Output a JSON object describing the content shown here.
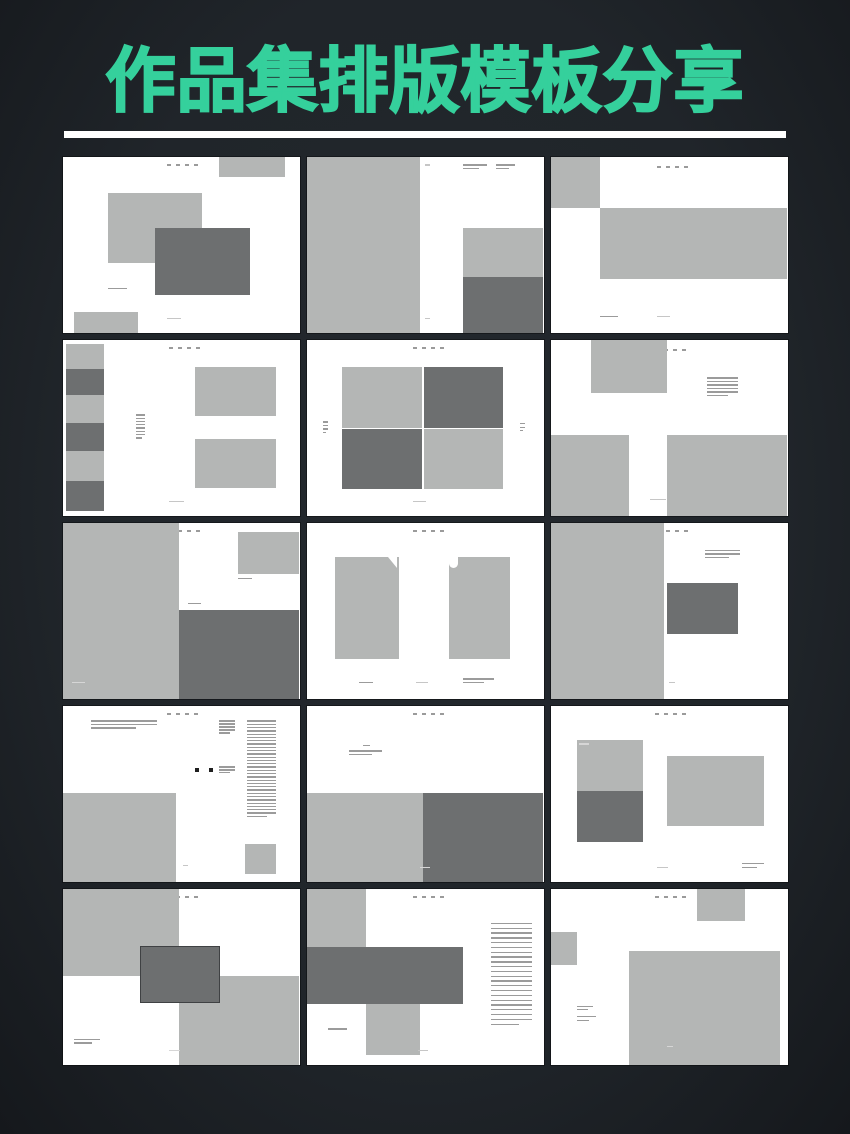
{
  "page": {
    "title": "作品集排版模板分享",
    "colors": {
      "background": "#20252a",
      "title_green": "#35d09c",
      "underline": "#ffffff",
      "slide_white": "#ffffff",
      "light_gray": "#b4b6b5",
      "dark_gray": "#6d6f70",
      "caption_gray": "#9b9b9b",
      "faint_gray": "#c6c6c6",
      "on_gray_text": "#d6d6d6",
      "bullet_black": "#1f1f1f",
      "center_rect_border": "#3f4143"
    }
  },
  "grid": {
    "rows": 5,
    "cols": 3,
    "thumb_count": 15
  },
  "thumbnails": [
    {
      "name": "spread-01-overlapping-images",
      "elements": [
        {
          "t": "dots",
          "x": 44,
          "y": 4
        },
        {
          "t": "rect",
          "x": 66,
          "y": 0,
          "w": 28,
          "h": 11,
          "tone": "light"
        },
        {
          "t": "rect",
          "x": 19,
          "y": 20,
          "w": 40,
          "h": 40,
          "tone": "light"
        },
        {
          "t": "rect",
          "x": 39,
          "y": 40,
          "w": 40,
          "h": 38,
          "tone": "dark"
        },
        {
          "t": "lines",
          "x": 19,
          "y": 74,
          "w": 12,
          "n": 1,
          "tone": "caption"
        },
        {
          "t": "rect",
          "x": 5,
          "y": 88,
          "w": 27,
          "h": 12,
          "tone": "light"
        },
        {
          "t": "lines",
          "x": 44,
          "y": 91,
          "w": 9,
          "n": 1,
          "tone": "faint"
        }
      ]
    },
    {
      "name": "spread-02-half-page-image",
      "elements": [
        {
          "t": "rect",
          "x": 0,
          "y": 0,
          "w": 48,
          "h": 100,
          "tone": "light"
        },
        {
          "t": "lines",
          "x": 66,
          "y": 4,
          "w": 10,
          "n": 2,
          "tone": "caption"
        },
        {
          "t": "lines",
          "x": 80,
          "y": 4,
          "w": 8,
          "n": 2,
          "tone": "caption"
        },
        {
          "t": "lines",
          "x": 50,
          "y": 4,
          "w": 3,
          "n": 1,
          "tone": "faint"
        },
        {
          "t": "rect",
          "x": 66,
          "y": 40,
          "w": 34,
          "h": 28,
          "tone": "light"
        },
        {
          "t": "rect",
          "x": 66,
          "y": 68,
          "w": 34,
          "h": 32,
          "tone": "dark"
        },
        {
          "t": "lines",
          "x": 50,
          "y": 91,
          "w": 3,
          "n": 1,
          "tone": "faint"
        }
      ]
    },
    {
      "name": "spread-03-banner-image",
      "elements": [
        {
          "t": "dots",
          "x": 45,
          "y": 5
        },
        {
          "t": "rect",
          "x": 0,
          "y": 0,
          "w": 21,
          "h": 29,
          "tone": "light"
        },
        {
          "t": "rect",
          "x": 21,
          "y": 29,
          "w": 79,
          "h": 40,
          "tone": "light"
        },
        {
          "t": "lines",
          "x": 21,
          "y": 90,
          "w": 11,
          "n": 1,
          "tone": "caption"
        },
        {
          "t": "lines",
          "x": 45,
          "y": 90,
          "w": 8,
          "n": 1,
          "tone": "faint"
        }
      ]
    },
    {
      "name": "spread-04-filmstrip-left",
      "elements": [
        {
          "t": "dots",
          "x": 45,
          "y": 4
        },
        {
          "t": "rect",
          "x": 1.5,
          "y": 2,
          "w": 16,
          "h": 14,
          "tone": "light"
        },
        {
          "t": "rect",
          "x": 1.5,
          "y": 16,
          "w": 16,
          "h": 15,
          "tone": "dark"
        },
        {
          "t": "rect",
          "x": 1.5,
          "y": 31,
          "w": 16,
          "h": 16,
          "tone": "light"
        },
        {
          "t": "rect",
          "x": 1.5,
          "y": 47,
          "w": 16,
          "h": 16,
          "tone": "dark"
        },
        {
          "t": "rect",
          "x": 1.5,
          "y": 63,
          "w": 16,
          "h": 17,
          "tone": "light"
        },
        {
          "t": "rect",
          "x": 1.5,
          "y": 80,
          "w": 16,
          "h": 17,
          "tone": "dark"
        },
        {
          "t": "lines",
          "x": 31,
          "y": 42,
          "w": 4,
          "n": 8,
          "lh": 3.3,
          "tone": "caption"
        },
        {
          "t": "rect",
          "x": 56,
          "y": 15,
          "w": 34,
          "h": 28,
          "tone": "light"
        },
        {
          "t": "rect",
          "x": 56,
          "y": 56,
          "w": 34,
          "h": 28,
          "tone": "light"
        },
        {
          "t": "lines",
          "x": 45,
          "y": 91,
          "w": 9,
          "n": 1,
          "tone": "faint"
        }
      ]
    },
    {
      "name": "spread-05-checkerboard-grid",
      "elements": [
        {
          "t": "dots",
          "x": 45,
          "y": 4
        },
        {
          "t": "rect",
          "x": 15,
          "y": 15,
          "w": 33.6,
          "h": 34.6,
          "tone": "light"
        },
        {
          "t": "rect",
          "x": 49.4,
          "y": 15,
          "w": 33.6,
          "h": 34.6,
          "tone": "dark"
        },
        {
          "t": "rect",
          "x": 15,
          "y": 50.4,
          "w": 33.6,
          "h": 34,
          "tone": "dark"
        },
        {
          "t": "rect",
          "x": 49.4,
          "y": 50.4,
          "w": 33.6,
          "h": 34,
          "tone": "light"
        },
        {
          "t": "lines",
          "x": 7,
          "y": 46,
          "w": 2,
          "n": 4,
          "tone": "caption"
        },
        {
          "t": "lines",
          "x": 90,
          "y": 47,
          "w": 2,
          "n": 3,
          "tone": "caption"
        },
        {
          "t": "lines",
          "x": 45,
          "y": 91,
          "w": 8,
          "n": 1,
          "tone": "faint"
        }
      ]
    },
    {
      "name": "spread-06-three-blocks",
      "elements": [
        {
          "t": "dots",
          "x": 44,
          "y": 5
        },
        {
          "t": "rect",
          "x": 17,
          "y": 0,
          "w": 32,
          "h": 30,
          "tone": "light"
        },
        {
          "t": "lines",
          "x": 66,
          "y": 21,
          "w": 13,
          "n": 6,
          "tone": "caption"
        },
        {
          "t": "rect",
          "x": 0,
          "y": 54,
          "w": 33,
          "h": 46,
          "tone": "light"
        },
        {
          "t": "rect",
          "x": 49,
          "y": 54,
          "w": 51,
          "h": 46,
          "tone": "light"
        },
        {
          "t": "lines",
          "x": 42,
          "y": 90,
          "w": 10,
          "n": 1,
          "tone": "faint"
        }
      ]
    },
    {
      "name": "spread-07-half-image-dark-corner",
      "elements": [
        {
          "t": "dots",
          "x": 45,
          "y": 4
        },
        {
          "t": "rect",
          "x": 0,
          "y": 0,
          "w": 49,
          "h": 100,
          "tone": "light"
        },
        {
          "t": "rect",
          "x": 74,
          "y": 5,
          "w": 26,
          "h": 24,
          "tone": "light"
        },
        {
          "t": "lines",
          "x": 74,
          "y": 31,
          "w": 9,
          "n": 1,
          "tone": "caption"
        },
        {
          "t": "lines",
          "x": 53,
          "y": 45,
          "w": 8,
          "n": 1,
          "tone": "caption"
        },
        {
          "t": "rect",
          "x": 49,
          "y": 49,
          "w": 51,
          "h": 51,
          "tone": "dark"
        },
        {
          "t": "lines",
          "x": 4,
          "y": 90,
          "w": 8,
          "n": 1,
          "tone": "onGray"
        }
      ]
    },
    {
      "name": "spread-08-two-portrait-images",
      "elements": [
        {
          "t": "dots",
          "x": 45,
          "y": 4
        },
        {
          "t": "rect",
          "x": 12,
          "y": 19,
          "w": 27,
          "h": 58,
          "tone": "light"
        },
        {
          "t": "rect",
          "x": 60,
          "y": 19,
          "w": 26,
          "h": 58,
          "tone": "light"
        },
        {
          "t": "notch",
          "x": 34.5,
          "y": 19,
          "shape": "v"
        },
        {
          "t": "notch",
          "x": 60,
          "y": 19,
          "shape": "j"
        },
        {
          "t": "lines",
          "x": 22,
          "y": 90,
          "w": 9,
          "n": 1,
          "tone": "caption"
        },
        {
          "t": "lines",
          "x": 46,
          "y": 90,
          "w": 8,
          "n": 1,
          "tone": "faint"
        },
        {
          "t": "lines",
          "x": 66,
          "y": 88,
          "w": 13,
          "n": 2,
          "tone": "caption"
        }
      ]
    },
    {
      "name": "spread-09-half-image-center-rect",
      "elements": [
        {
          "t": "dots",
          "x": 45,
          "y": 4
        },
        {
          "t": "rect",
          "x": 0,
          "y": 0,
          "w": 48,
          "h": 100,
          "tone": "light"
        },
        {
          "t": "lines",
          "x": 65,
          "y": 15,
          "w": 15,
          "n": 3,
          "tone": "caption"
        },
        {
          "t": "rect",
          "x": 49,
          "y": 34,
          "w": 30,
          "h": 29,
          "tone": "dark"
        },
        {
          "t": "lines",
          "x": 50,
          "y": 90,
          "w": 4,
          "n": 1,
          "tone": "faint"
        }
      ]
    },
    {
      "name": "spread-10-text-heavy-editorial",
      "elements": [
        {
          "t": "dots",
          "x": 44,
          "y": 4
        },
        {
          "t": "lines",
          "x": 12,
          "y": 8,
          "w": 28,
          "n": 3,
          "tone": "caption"
        },
        {
          "t": "lines",
          "x": 66,
          "y": 8,
          "w": 7,
          "n": 5,
          "lh": 3,
          "tone": "caption"
        },
        {
          "t": "lines",
          "x": 78,
          "y": 8,
          "w": 12,
          "n": 30,
          "lh": 3.3,
          "tone": "caption"
        },
        {
          "t": "bullet",
          "x": 56,
          "y": 35
        },
        {
          "t": "bullet",
          "x": 62,
          "y": 35
        },
        {
          "t": "lines",
          "x": 66,
          "y": 34,
          "w": 7,
          "n": 3,
          "lh": 3,
          "tone": "caption"
        },
        {
          "t": "rect",
          "x": 0,
          "y": 49,
          "w": 48,
          "h": 51,
          "tone": "light"
        },
        {
          "t": "rect",
          "x": 77,
          "y": 78,
          "w": 13,
          "h": 17,
          "tone": "light"
        },
        {
          "t": "lines",
          "x": 51,
          "y": 90,
          "w": 3,
          "n": 1,
          "tone": "faint"
        }
      ]
    },
    {
      "name": "spread-11-split-bottom-half",
      "elements": [
        {
          "t": "dots",
          "x": 45,
          "y": 4
        },
        {
          "t": "lines",
          "x": 24,
          "y": 22,
          "w": 4,
          "n": 1,
          "tone": "caption"
        },
        {
          "t": "lines",
          "x": 18,
          "y": 25,
          "w": 14,
          "n": 2,
          "tone": "caption"
        },
        {
          "t": "rect",
          "x": 0,
          "y": 49,
          "w": 49,
          "h": 51,
          "tone": "light"
        },
        {
          "t": "rect",
          "x": 49,
          "y": 49,
          "w": 51,
          "h": 51,
          "tone": "dark"
        },
        {
          "t": "lines",
          "x": 48,
          "y": 91,
          "w": 6,
          "n": 1,
          "tone": "onGray"
        }
      ]
    },
    {
      "name": "spread-12-stacked-and-single",
      "elements": [
        {
          "t": "dots",
          "x": 44,
          "y": 4
        },
        {
          "t": "rect",
          "x": 11,
          "y": 19,
          "w": 28,
          "h": 29,
          "tone": "light"
        },
        {
          "t": "rect",
          "x": 11,
          "y": 48,
          "w": 28,
          "h": 29,
          "tone": "dark"
        },
        {
          "t": "lines",
          "x": 12,
          "y": 21,
          "w": 6,
          "n": 1,
          "tone": "onGray"
        },
        {
          "t": "rect",
          "x": 49,
          "y": 28,
          "w": 41,
          "h": 40,
          "tone": "light"
        },
        {
          "t": "lines",
          "x": 45,
          "y": 91,
          "w": 7,
          "n": 1,
          "tone": "faint"
        },
        {
          "t": "lines",
          "x": 81,
          "y": 89,
          "w": 9,
          "n": 2,
          "tone": "caption"
        }
      ]
    },
    {
      "name": "spread-13-checker-center-overlay",
      "elements": [
        {
          "t": "dots",
          "x": 44,
          "y": 4
        },
        {
          "t": "rect",
          "x": 0,
          "y": 0,
          "w": 49,
          "h": 49,
          "tone": "light"
        },
        {
          "t": "rect",
          "x": 49,
          "y": 49,
          "w": 51,
          "h": 51,
          "tone": "light"
        },
        {
          "t": "rect",
          "x": 33,
          "y": 33,
          "w": 33,
          "h": 31,
          "tone": "dark",
          "border": true
        },
        {
          "t": "lines",
          "x": 5,
          "y": 85,
          "w": 11,
          "n": 2,
          "tone": "caption"
        },
        {
          "t": "lines",
          "x": 45,
          "y": 91,
          "w": 7,
          "n": 1,
          "tone": "onGray"
        }
      ]
    },
    {
      "name": "spread-14-band-with-index-list",
      "elements": [
        {
          "t": "dots",
          "x": 45,
          "y": 4
        },
        {
          "t": "rect",
          "x": 0,
          "y": 0,
          "w": 25,
          "h": 33,
          "tone": "light"
        },
        {
          "t": "rect",
          "x": 0,
          "y": 33,
          "w": 66,
          "h": 32,
          "tone": "dark"
        },
        {
          "t": "rect",
          "x": 25,
          "y": 65,
          "w": 23,
          "h": 29,
          "tone": "light"
        },
        {
          "t": "lines",
          "x": 78,
          "y": 19,
          "w": 17,
          "n": 22,
          "lh": 4.8,
          "tone": "caption"
        },
        {
          "t": "lines",
          "x": 9,
          "y": 79,
          "w": 12,
          "n": 1,
          "tone": "caption"
        },
        {
          "t": "lines",
          "x": 47,
          "y": 91,
          "w": 6,
          "n": 1,
          "tone": "faint"
        }
      ]
    },
    {
      "name": "spread-15-corner-blocks-large-image",
      "elements": [
        {
          "t": "dots",
          "x": 44,
          "y": 4
        },
        {
          "t": "rect",
          "x": 62,
          "y": 0,
          "w": 20,
          "h": 18,
          "tone": "light"
        },
        {
          "t": "rect",
          "x": 0,
          "y": 24,
          "w": 11,
          "h": 19,
          "tone": "light"
        },
        {
          "t": "rect",
          "x": 33,
          "y": 35,
          "w": 64,
          "h": 65,
          "tone": "light"
        },
        {
          "t": "lines",
          "x": 11,
          "y": 66,
          "w": 7,
          "n": 2,
          "tone": "caption"
        },
        {
          "t": "lines",
          "x": 11,
          "y": 72,
          "w": 8,
          "n": 2,
          "tone": "caption"
        },
        {
          "t": "lines",
          "x": 49,
          "y": 89,
          "w": 4,
          "n": 1,
          "tone": "onGray"
        }
      ]
    }
  ]
}
